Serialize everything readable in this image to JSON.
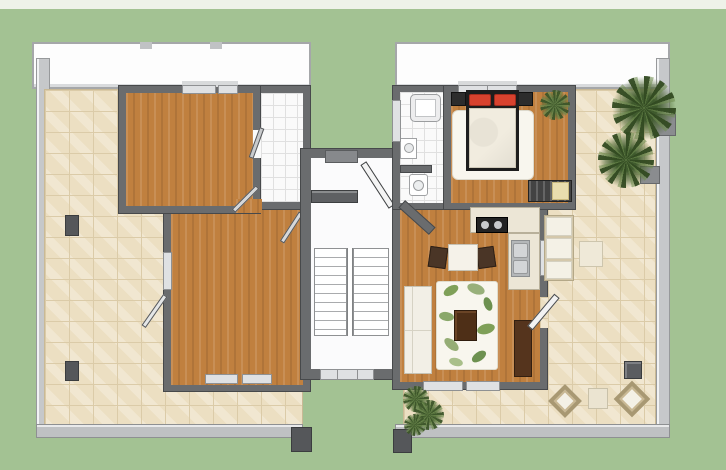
{
  "meta": {
    "kind": "architectural-floor-plan-render",
    "view": "top-down",
    "text_content": "none"
  },
  "palette": {
    "grass": "#a3c293",
    "sky": "#eef2e9",
    "roof": "#fdfdfd",
    "roof-line": "#a5a7a9",
    "wall": "#6a6c6e",
    "wall-line": "#47494b",
    "parapet": "#c6c8ca",
    "rail": "#bfc1c3",
    "tile": "#ecdfc2",
    "tile-joint": "#dbcba8",
    "wtile": "#fafafa",
    "wtile-joint": "#e0e0e0",
    "wood": "#c0803f",
    "stairfloor": "#fbfbfc",
    "step": "#a9abad",
    "win": "#dfe1e3",
    "win-line": "#8f9193",
    "bedframe": "#1d1d1d",
    "pillow": "#d8422e",
    "duvet": "#f1ecdf",
    "sofa": "#f2efe6",
    "rug": "#f8f6ee",
    "tbrown": "#4e2f17",
    "chair": "#4a3526",
    "counter": "#ece6d6",
    "counter-line": "#b8b09a",
    "cooktop": "#232323",
    "steel": "#b4b7b9",
    "palm": "#3c5529",
    "palm-lite": "#6e8c4e",
    "shrub": "#6d8a4c",
    "cushion": "#f4f1e6",
    "lframe": "#d4c8ab",
    "post": "#55575a",
    "dark-door": "#5e6063"
  },
  "scene": {
    "left_unit": {
      "terrace": "l-shaped-beige-tile-terrace-west-and-south",
      "rooms": [
        "empty-room-north-wood-floor",
        "empty-room-south-wood-floor",
        "white-tiled-entry-loggia"
      ],
      "doors": [
        "terrace-door-southwest",
        "interior-door-north-room",
        "interior-door-south-room",
        "entrance-door-to-stairwell"
      ],
      "terrace_objects": [
        "post-upper",
        "post-lower",
        "corner-post"
      ]
    },
    "stairwell": {
      "stairs": "double-flight-with-center-divider",
      "openings": [
        "window-south",
        "left-unit-entrance",
        "right-unit-entrance-diagonal"
      ]
    },
    "right_unit": {
      "rooms": [
        "bathroom-with-tub-basin-wc",
        "bedroom-double-bed",
        "open-kitchen-living-dining"
      ],
      "furniture": [
        "double-bed-red-pillows",
        "nightstands",
        "indoor-plant",
        "dresser",
        "kitchen-l-counter-cooktop-sink",
        "dining-table-two-chairs",
        "sofa",
        "leaf-pattern-rug",
        "coffee-table",
        "tv-cabinet"
      ],
      "terrace": "l-shaped-beige-tile-terrace-east-and-south",
      "terrace_objects": [
        "two-palm-trees",
        "planters",
        "sun-lounger",
        "side-table-north",
        "grill-box",
        "two-diamond-armchairs",
        "side-table-south",
        "shrubs"
      ]
    }
  }
}
